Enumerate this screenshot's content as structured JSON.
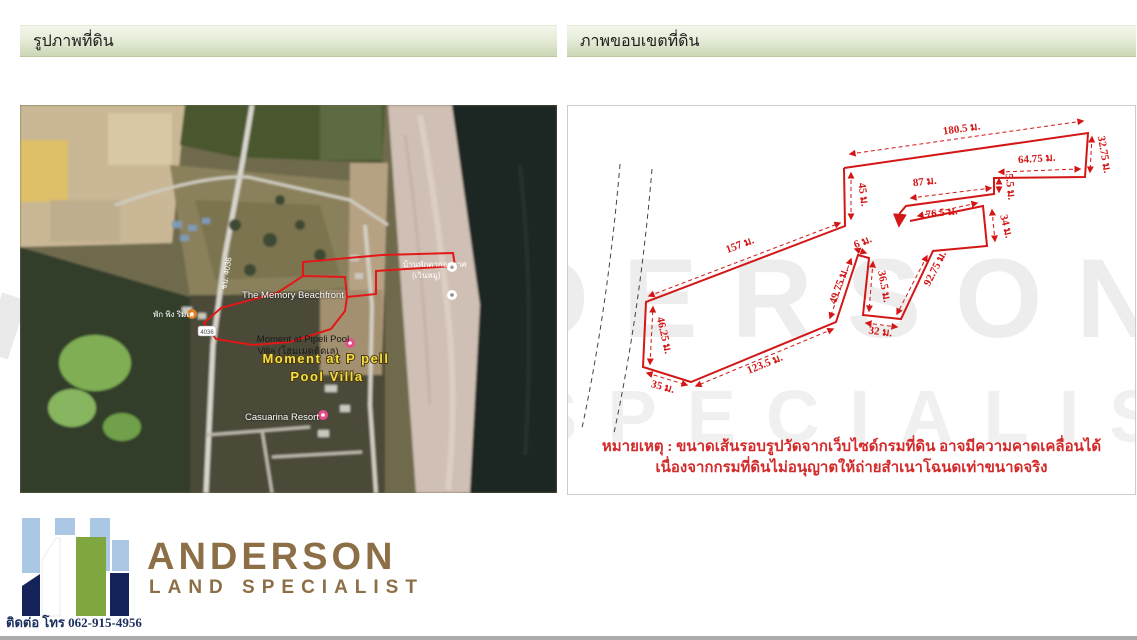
{
  "left_panel": {
    "title": "รูปภาพที่ดิน"
  },
  "right_panel": {
    "title": "ภาพขอบเขตที่ดิน",
    "note_line1": "หมายเหตุ : ขนาดเส้นรอบรูปวัดจากเว็บไซด์กรมที่ดิน อาจมีความคาดเคลื่อนได้",
    "note_line2": "เนื่องจากกรมที่ดินไม่อนุญาตให้ถ่ายสำเนาโฉนดเท่าขนาดจริง"
  },
  "diagram": {
    "unit": "ม.",
    "measurements": [
      "180.5 ม.",
      "32.75 ม.",
      "64.75 ม.",
      "5.5 ม.",
      "87 ม.",
      "76.5 ม.",
      "34 ม.",
      "92.75 ม.",
      "32 ม.",
      "36.5 ม.",
      "6 ม.",
      "49.75 ม.",
      "123.5 ม.",
      "35 ม.",
      "46.25 ม.",
      "157 ม.",
      "45 ม."
    ],
    "boundary_color": "#d31616",
    "coastline_color": "#444444"
  },
  "map": {
    "labels": {
      "memory": "The Memory Beachfront",
      "baanpak_line1": "บ้านพักตากอากาศ",
      "baanpak_line2": "(เวินหมู)",
      "moment_poi_line1": "Moment at Pipeli Pool",
      "moment_poi_line2": "Villa (โฮมเมดติดเล)",
      "moment_big_line1": "Moment at P pell",
      "moment_big_line2": "Pool Villa",
      "casuarina": "Casuarina Resort",
      "pakping": "พัก พิง ริมเล",
      "road_label": "ชบ. 4036",
      "road_shield": "4036"
    },
    "poi_colors": {
      "hotel_pink": "#e84d8a",
      "lodge_orange": "#e08024",
      "generic_white": "#ffffff"
    }
  },
  "watermark": {
    "line1": "DERSON",
    "line2": "SPECIALIST"
  },
  "logo": {
    "name": "ANDERSON",
    "tagline": "LAND SPECIALIST",
    "phone": "ติดต่อ โทร 062-915-4956",
    "brand_brown": "#8d6f47",
    "navy": "#14235a",
    "green": "#7fa63f",
    "light_blue": "#aac7e4"
  }
}
